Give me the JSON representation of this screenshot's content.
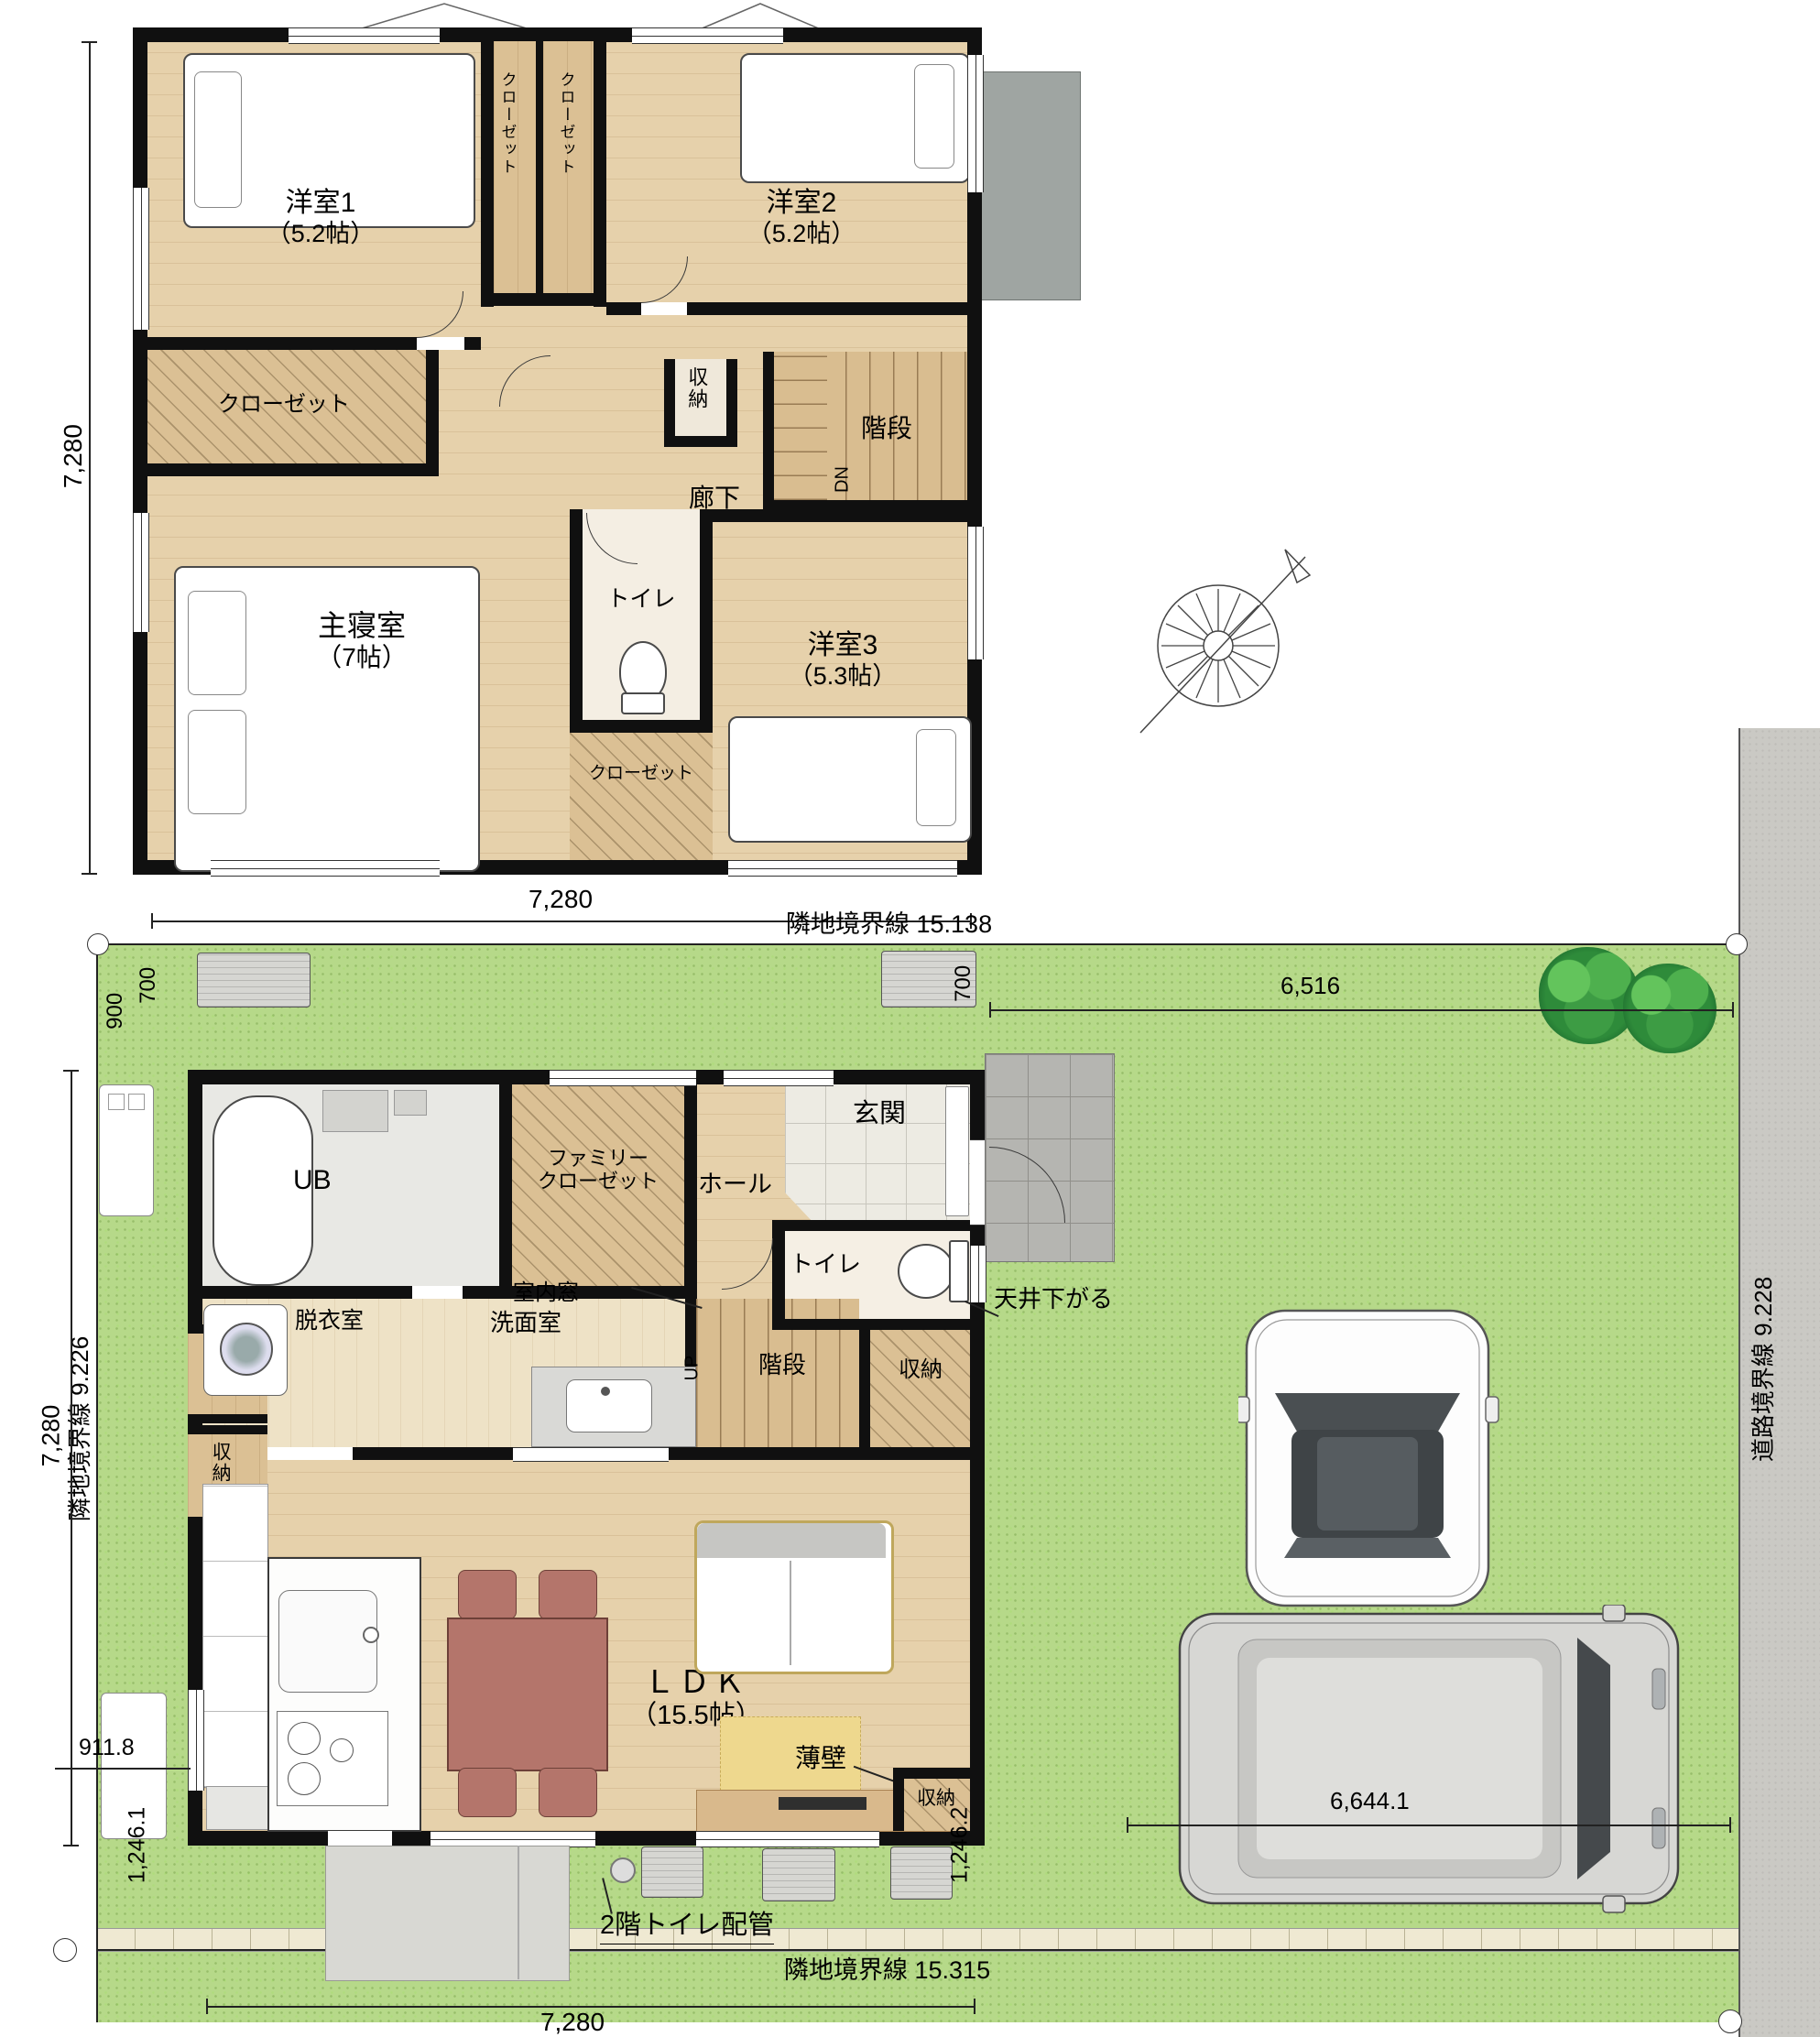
{
  "f2": {
    "y1": "洋室1",
    "y1s": "（5.2帖）",
    "y2": "洋室2",
    "y2s": "（5.2帖）",
    "y3": "洋室3",
    "y3s": "（5.3帖）",
    "master": "主寝室",
    "masters": "（7帖）",
    "closet": "クローゼット",
    "shuno": "収納",
    "kaidan": "階段",
    "roka": "廊下",
    "dn": "DN",
    "toilet": "トイレ",
    "dim_left": "7,280",
    "dim_bottom": "7,280"
  },
  "f1": {
    "ub": "UB",
    "fam1": "ファミリー",
    "fam2": "クローゼット",
    "genkan": "玄関",
    "hall": "ホール",
    "toilet": "トイレ",
    "datsui": "脱衣室",
    "senmen": "洗面室",
    "mado": "室内窓",
    "kaidan": "階段",
    "up": "UP",
    "shuno": "収納",
    "ldk": "ＬＤＫ",
    "ldks": "（15.5帖）",
    "usukabe": "薄壁",
    "tenjo": "天井下がる",
    "haikan": "2階トイレ配管"
  },
  "site": {
    "b_top": "隣地境界線 15.138",
    "b_left": "隣地境界線 9.226",
    "b_right": "道路境界線 9.228",
    "b_bottom": "隣地境界線 15.315",
    "d6516": "6,516",
    "d900": "900",
    "d700": "700",
    "d7280": "7,280",
    "d911": "911.8",
    "d1246a": "1,246.1",
    "d1246b": "1,246.2",
    "d6644": "6,644.1"
  },
  "colors": {
    "wall": "#101010",
    "wood": "#e6d1ab",
    "green": "#b6d989",
    "road": "#cac9c4",
    "genkan_tile": "#edebe3",
    "porch_tile": "#b5b5b1",
    "table_accent": "#b4756b"
  }
}
